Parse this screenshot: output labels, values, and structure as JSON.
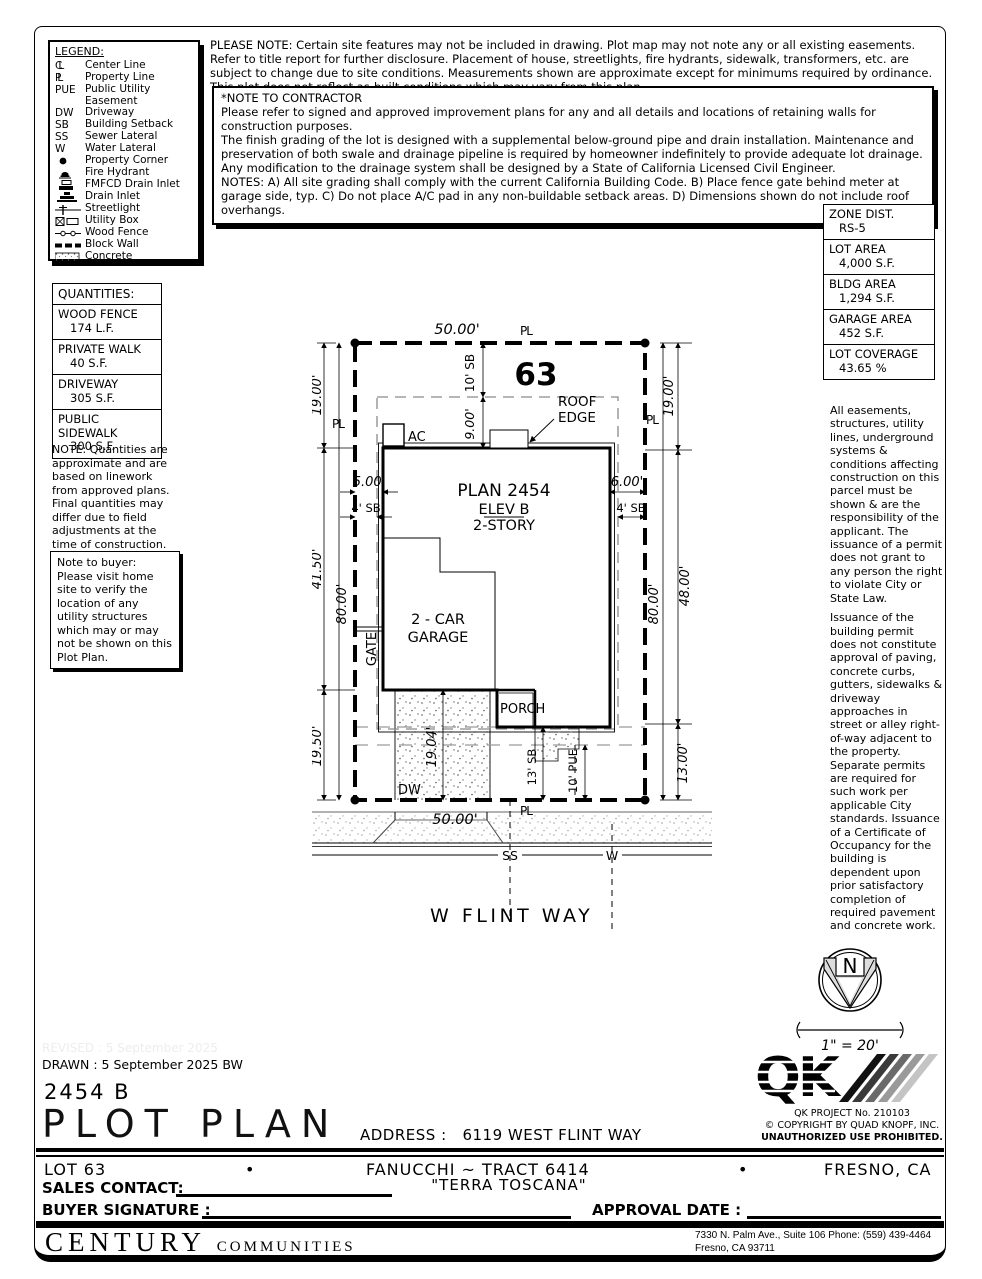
{
  "legend": {
    "title": "LEGEND:",
    "items": [
      {
        "symbol": "CL",
        "label": "Center Line"
      },
      {
        "symbol": "PL",
        "label": "Property Line"
      },
      {
        "symbol": "PUE",
        "label": "Public Utility Easement"
      },
      {
        "symbol": "DW",
        "label": "Driveway"
      },
      {
        "symbol": "SB",
        "label": "Building Setback"
      },
      {
        "symbol": "SS",
        "label": "Sewer Lateral"
      },
      {
        "symbol": "W",
        "label": "Water Lateral"
      },
      {
        "icon": "property-corner",
        "label": "Property Corner"
      },
      {
        "icon": "fire-hydrant",
        "label": "Fire Hydrant"
      },
      {
        "icon": "fmfcd-drain-inlet",
        "label": "FMFCD Drain Inlet"
      },
      {
        "icon": "drain-inlet",
        "label": "Drain Inlet"
      },
      {
        "icon": "streetlight",
        "label": "Streetlight"
      },
      {
        "icon": "utility-box",
        "label": "Utility Box"
      },
      {
        "icon": "wood-fence",
        "label": "Wood Fence"
      },
      {
        "icon": "block-wall",
        "label": "Block Wall"
      },
      {
        "icon": "concrete",
        "label": "Concrete"
      }
    ]
  },
  "please_note": "PLEASE NOTE:  Certain site features may not be included in drawing.  Plot map may not note any or all existing easements. Refer to title report for further disclosure.  Placement of house, streetlights, fire hydrants, sidewalk, transformers, etc. are subject to change due to site conditions.  Measurements shown are approximate except for minimums required by ordinance.  This plot does not reflect as-built conditions which may vary from this plan.",
  "contractor_note": {
    "title": "*NOTE TO CONTRACTOR",
    "p1": "Please refer to signed and approved improvement plans for any and all details and locations of retaining walls for construction purposes.",
    "p2": "The finish grading of the lot is designed with a supplemental below-ground pipe and drain installation.  Maintenance and preservation of both swale and drainage pipeline is required by homeowner indefinitely to provide adequate lot drainage.  Any modification to the drainage system shall be designed by a State of California Licensed Civil Engineer.",
    "p3": "NOTES:  A) All site grading shall comply with the current California Building Code.  B) Place fence gate behind meter at garage side, typ.  C) Do not place A/C pad in any non-buildable setback areas.  D) Dimensions shown do not include roof overhangs."
  },
  "zone_table": {
    "rows": [
      {
        "label": "ZONE DIST.",
        "value": "RS-5"
      },
      {
        "label": "LOT AREA",
        "value": "4,000 S.F."
      },
      {
        "label": "BLDG AREA",
        "value": "1,294 S.F."
      },
      {
        "label": "GARAGE AREA",
        "value": "452 S.F."
      },
      {
        "label": "LOT COVERAGE",
        "value": "43.65 %"
      }
    ]
  },
  "quantities": {
    "title": "QUANTITIES:",
    "rows": [
      {
        "label": "WOOD FENCE",
        "value": "174 L.F."
      },
      {
        "label": "PRIVATE WALK",
        "value": "40 S.F."
      },
      {
        "label": "DRIVEWAY",
        "value": "305 S.F."
      },
      {
        "label": "PUBLIC SIDEWALK",
        "value": "300 S.F."
      }
    ],
    "note": "NOTE: Quantities are approximate and are based on linework from approved plans.  Final quantities may differ due to field adjustments at the time of construction."
  },
  "buyer_note": "Note to buyer: Please visit home site to verify the location of any utility structures which may or may not be shown on this Plot Plan.",
  "right_notes": {
    "p1": "All easements, structures, utility lines, underground systems & conditions affecting construction on this parcel must be shown & are the responsibility of the applicant. The issuance of a permit does not grant to any person the right to violate City or State Law.",
    "p2": "Issuance of the building permit does not constitute approval of paving, concrete curbs, gutters, sidewalks & driveway approaches in street or alley right-of-way adjacent to the property. Separate permits are required for such work per applicable City standards. Issuance of a Certificate of Occupancy for the building is dependent upon prior satisfactory completion of required pavement and concrete work."
  },
  "drawing": {
    "lot_number": "63",
    "pl": "PL",
    "dim_width_top": "50.00'",
    "dim_width_bottom": "50.00'",
    "dim_19": "19.00'",
    "dim_4150": "41.50'",
    "dim_80": "80.00'",
    "dim_1950": "19.50'",
    "dim_48": "48.00'",
    "dim_1300": "13.00'",
    "front_sb": "10' SB",
    "front_roof": "9.00'",
    "side_left": "5.00'",
    "side_right": "6.00'",
    "sb_side": "4' SB",
    "plan_name": "PLAN 2454",
    "plan_elev": "ELEV B",
    "plan_story": "2-STORY",
    "garage_line1": "2 - CAR",
    "garage_line2": "GARAGE",
    "gate": "GATE",
    "porch": "PORCH",
    "ac": "AC",
    "roof_edge_line1": "ROOF",
    "roof_edge_line2": "EDGE",
    "dim_driveway": "19.04'",
    "dw": "DW",
    "rear_sb": "13' SB",
    "rear_pue": "10' PUE",
    "ss": "SS",
    "w": "W",
    "street_name": "W FLINT WAY"
  },
  "north": {
    "label": "N",
    "scale": "1\" = 20'"
  },
  "qk": {
    "project": "QK PROJECT No. 210103",
    "copyright": "©  COPYRIGHT BY QUAD KNOPF, INC.",
    "unauthorized": "UNAUTHORIZED USE PROHIBITED."
  },
  "title_block": {
    "revised": "REVISED :  5 September 2025",
    "drawn": "DRAWN :  5 September 2025  BW",
    "plan_code": "2454 B",
    "sheet_title": "PLOT PLAN",
    "address_label": "ADDRESS :",
    "address": "6119 WEST FLINT WAY"
  },
  "footer": {
    "lot": "LOT 63",
    "bullet": "•",
    "tract": "FANUCCHI ~ TRACT 6414",
    "community": "\"TERRA TOSCANA\"",
    "city": "FRESNO, CA",
    "sales_label": "SALES CONTACT:",
    "buyer_label": "BUYER SIGNATURE :",
    "approval_label": "APPROVAL DATE :",
    "company_name": "CENTURY",
    "company_suffix": "COMMUNITIES",
    "address_line1": "7330 N. Palm Ave., Suite 106    Phone:  (559) 439-4464",
    "address_line2": "Fresno, CA  93711"
  }
}
